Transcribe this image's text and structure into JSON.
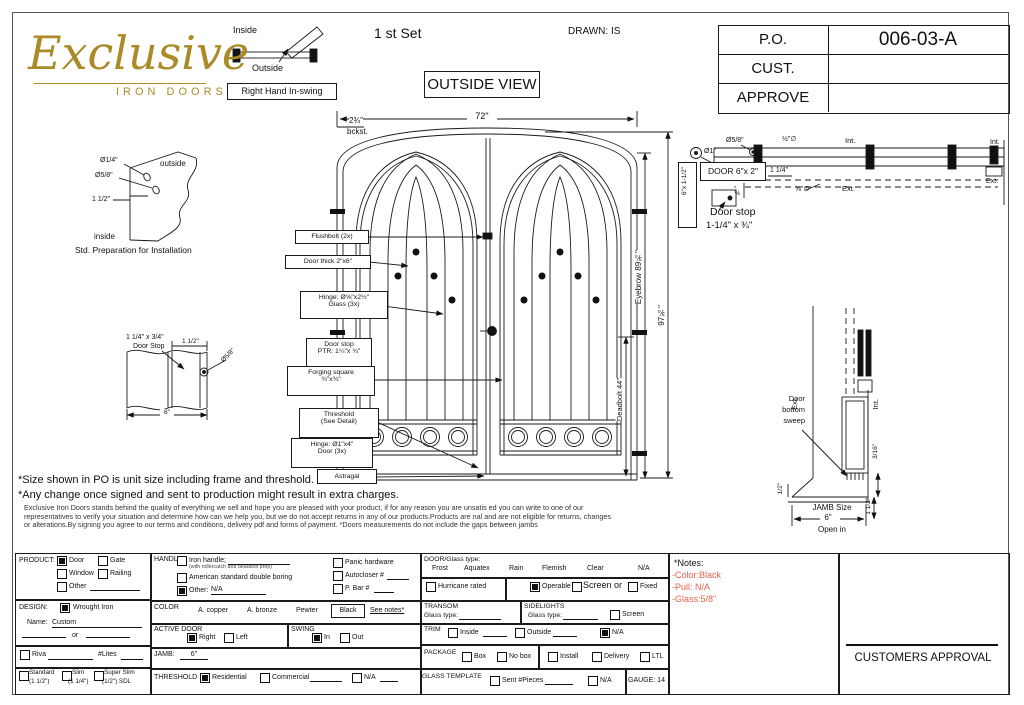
{
  "header": {
    "logo_main": "Exclusive",
    "logo_sub": "IRON DOORS",
    "swing_inside": "Inside",
    "swing_outside": "Outside",
    "swing_label": "Right Hand In-swing",
    "set_label": "1 st Set",
    "drawn_label": "DRAWN: IS",
    "view_label": "OUTSIDE VIEW",
    "po": {
      "r0l": "P.O.",
      "r0v": "006-03-A",
      "r1l": "CUST.",
      "r1v": "",
      "r2l": "APPROVE",
      "r2v": ""
    }
  },
  "prep": {
    "dia_quarter": "Ø1/4\"",
    "dia_fiveeighth": "Ø5/8\"",
    "dim_half": "1 1/2\"",
    "outside": "outside",
    "inside": "inside",
    "caption": "Std. Preparation for Installation"
  },
  "stop_detail": {
    "line1": "1 1/4\" x 3/4\"",
    "line2": "Door Stop",
    "dim1": "1 1/2\"",
    "dia": "Ø5/8\"",
    "width": "6\""
  },
  "elevation": {
    "width_dim": "72\"",
    "backset1": "2¾\"",
    "backset2": "bckst.",
    "flushbolt": "Flushbolt (2x)",
    "door_thick": "Door thick 2\"x6\"",
    "hinge_small_1": "Hinge: Ø⅝\"x2½\"",
    "hinge_small_2": "Glass (3x)",
    "door_stop_1": "Door stop",
    "door_stop_2": "PTR: 1¼\"x ¾\"",
    "forging_1": "Forging square",
    "forging_2": "¾\"x¾\"",
    "threshold_1": "Threshold",
    "threshold_2": "(See Detail)",
    "hinge_main_1": "Hinge: Ø1\"x4\"",
    "hinge_main_2": "Door (3x)",
    "astragal": "Astragal",
    "dim_eyebrow": "Eyebrow 89¾\"",
    "dim_height": "97¾\"",
    "dim_deadbolt": "Deadbolt 44\""
  },
  "head": {
    "dia_1": "Ø1\"",
    "dia_58": "Ø5/8\"",
    "dia_half": "½\"∅",
    "door_label": "DOOR 6\"x 2\"",
    "jamb_label": "6\"x 1-1/2\"",
    "dim_114": "1 1/4\"",
    "dim_38": "⅜\"",
    "dia_58b": "⅝\"∅",
    "int1": "Int.",
    "ext1": "Ext.",
    "int2": "Int.",
    "ext2": "Ext.",
    "stop_1": "Door stop",
    "stop_2": "1-1/4\" x ¾\""
  },
  "sill": {
    "ext": "Ext.",
    "int": "Int.",
    "sweep_1": "Door",
    "sweep_2": "bottom",
    "sweep_3": "sweep",
    "dim_316": "3/16\"",
    "dim_112": "1 1/2\"",
    "dim_12": "1/2\"",
    "jamb_1": "JAMB Size",
    "jamb_2": "6\"",
    "jamb_3": "Open in"
  },
  "notes_mid": {
    "line1": "*Size shown in PO is unit size including frame and threshold.",
    "line2": "*Any change once signed and sent to production might result in extra charges.",
    "para1": "Exclusive Iron Doors stands behind the quality of everything we sell and hope you are pleased with your product, if for any reason you are unsatis ed you can write to one of our",
    "para2": "representatives to verify your situation and determine how can we help you, but we do not accept returns in any of our products.Products are nal and are not eligible for returns, changes",
    "para3": "or alterations.By signing you agree to our terms and conditions, delivery pdf and forms of payment. *Doors measurements do not include the gaps between jambs"
  },
  "form": {
    "product": {
      "label": "PRODUCT:",
      "door": "Door",
      "gate": "Gate",
      "window": "Window",
      "railing": "Railing",
      "other": "Other"
    },
    "design": {
      "label": "DESIGN:",
      "wrought": "Wrought Iron",
      "name_label": "Name:",
      "name_value": "Custom",
      "or": "or"
    },
    "riva": {
      "label": "Riva",
      "lites": "#Lites"
    },
    "frames": {
      "standard": "Standard",
      "standard_sub": "(1 1/2\")",
      "slim": "Slim",
      "slim_sub": "(1 1/4\")",
      "super": "Super Slim",
      "super_sub": "(1/2\") SDL"
    },
    "handle": {
      "label": "HANDLE",
      "iron": "Iron handle;",
      "iron_sub": "(with rollercatch and deadbolt prep)",
      "american": "American standard double boring",
      "other": "Other:",
      "other_value": "N/A",
      "panic": "Panic hardware",
      "autocloser": "Autocloser #",
      "pbar": "P. Bar #"
    },
    "color": {
      "label": "COLOR",
      "copper": "A. copper",
      "bronze": "A. bronze",
      "pewter": "Pewter",
      "black": "Black",
      "see_notes": "See notes*"
    },
    "active": {
      "label": "ACTIVE DOOR",
      "right": "Right",
      "left": "Left"
    },
    "swing": {
      "label": "SWING",
      "in": "In",
      "out": "Out"
    },
    "jamb": {
      "label": "JAMB:",
      "value": "6\""
    },
    "threshold": {
      "label": "THRESHOLD",
      "residential": "Residential",
      "commercial": "Commercial",
      "na": "N/A"
    },
    "glass": {
      "label": "DOOR/Glass type:",
      "frost": "Frost",
      "aquatex": "Aquatex",
      "rain": "Rain",
      "flemish": "Flemish",
      "clear": "Clear",
      "na": "N/A",
      "hurricane": "Hurricane rated",
      "operable": "Operable",
      "screen_or": "Screen or",
      "fixed": "Fixed"
    },
    "transom": {
      "label": "TRANSOM",
      "glass_type": "Glass type:"
    },
    "sidelights": {
      "label": "SIDELIGHTS",
      "glass_type": "Glass type:",
      "screen": "Screen"
    },
    "trim": {
      "label": "TRIM",
      "inside": "Inside",
      "outside": "Outside",
      "na": "N/A"
    },
    "package": {
      "label": "PACKAGE",
      "box": "Box",
      "nobox": "No box",
      "install": "Install",
      "delivery": "Delivery",
      "ltl": "LTL"
    },
    "gt": {
      "label": "GLASS TEMPLATE",
      "sent": "Sent #Pieces",
      "na": "N/A",
      "gauge": "GAUGE: 14"
    }
  },
  "notes_box": {
    "title": "*Notes:",
    "item_color": "-Color:Black",
    "item_pull": "-Pull: N/A",
    "item_glass": "-Glass:5/8\""
  },
  "approval": {
    "label": "CUSTOMERS APPROVAL"
  }
}
